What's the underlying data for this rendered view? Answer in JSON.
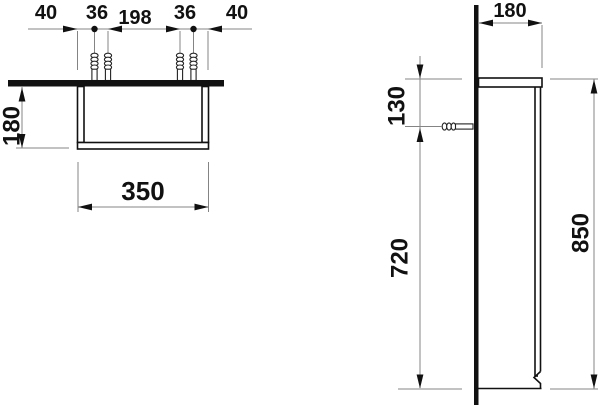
{
  "drawing_type": "technical-dimension-drawing",
  "units": "mm",
  "front_view": {
    "chain_dimensions": [
      "40",
      "36",
      "198",
      "36",
      "40"
    ],
    "height": "180",
    "width": "350"
  },
  "side_view": {
    "depth": "180",
    "screw_height_offset": "130",
    "carcass_height": "720",
    "total_height": "850"
  },
  "colors": {
    "background": "#ffffff",
    "structure_line": "#111111",
    "thin_dimension_line": "#848484",
    "text": "#111111"
  }
}
